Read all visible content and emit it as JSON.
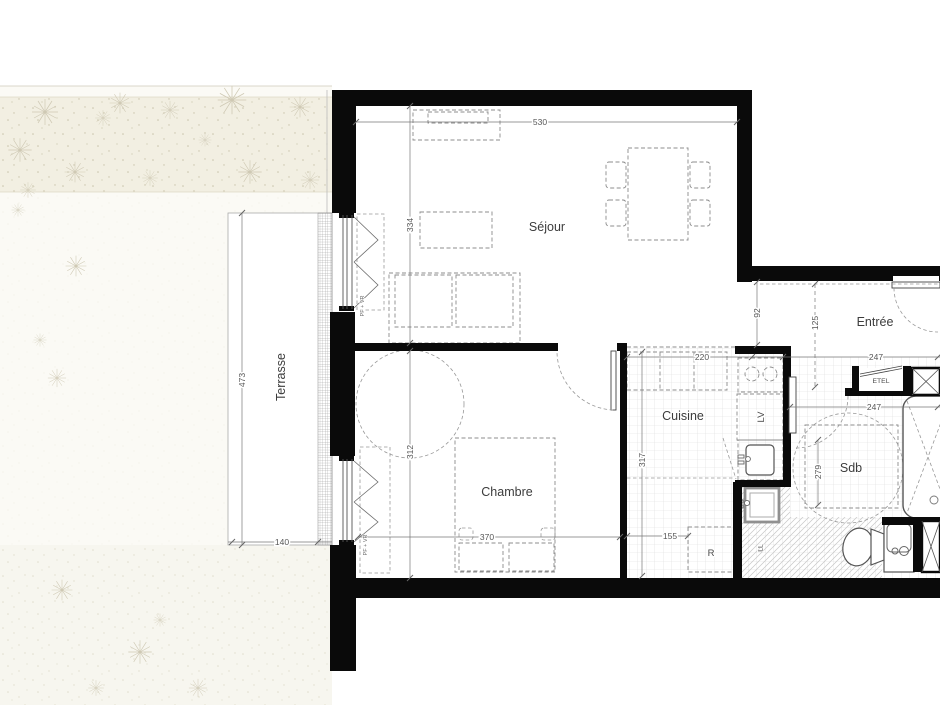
{
  "plan": {
    "rooms": {
      "sejour": "Séjour",
      "chambre": "Chambre",
      "cuisine": "Cuisine",
      "entree": "Entrée",
      "sdb": "Sdb",
      "terrasse": "Terrasse"
    },
    "closets": {
      "etel": "ETEL"
    },
    "appliances": {
      "dishwasher": "LV",
      "washer": "LL",
      "fridge": "R"
    },
    "window_label": "PF + VR",
    "dims": {
      "sejour_width": "530",
      "sejour_depth": "334",
      "chambre_depth": "312",
      "chambre_width": "370",
      "terrasse_depth": "473",
      "terrasse_width": "140",
      "cuisine_width": "220",
      "cuisine_depth": "317",
      "fridge_nook": "155",
      "passage": "92",
      "entree": "125",
      "entree_width": "247",
      "sdb_width": "247",
      "sdb_depth": "279"
    }
  }
}
